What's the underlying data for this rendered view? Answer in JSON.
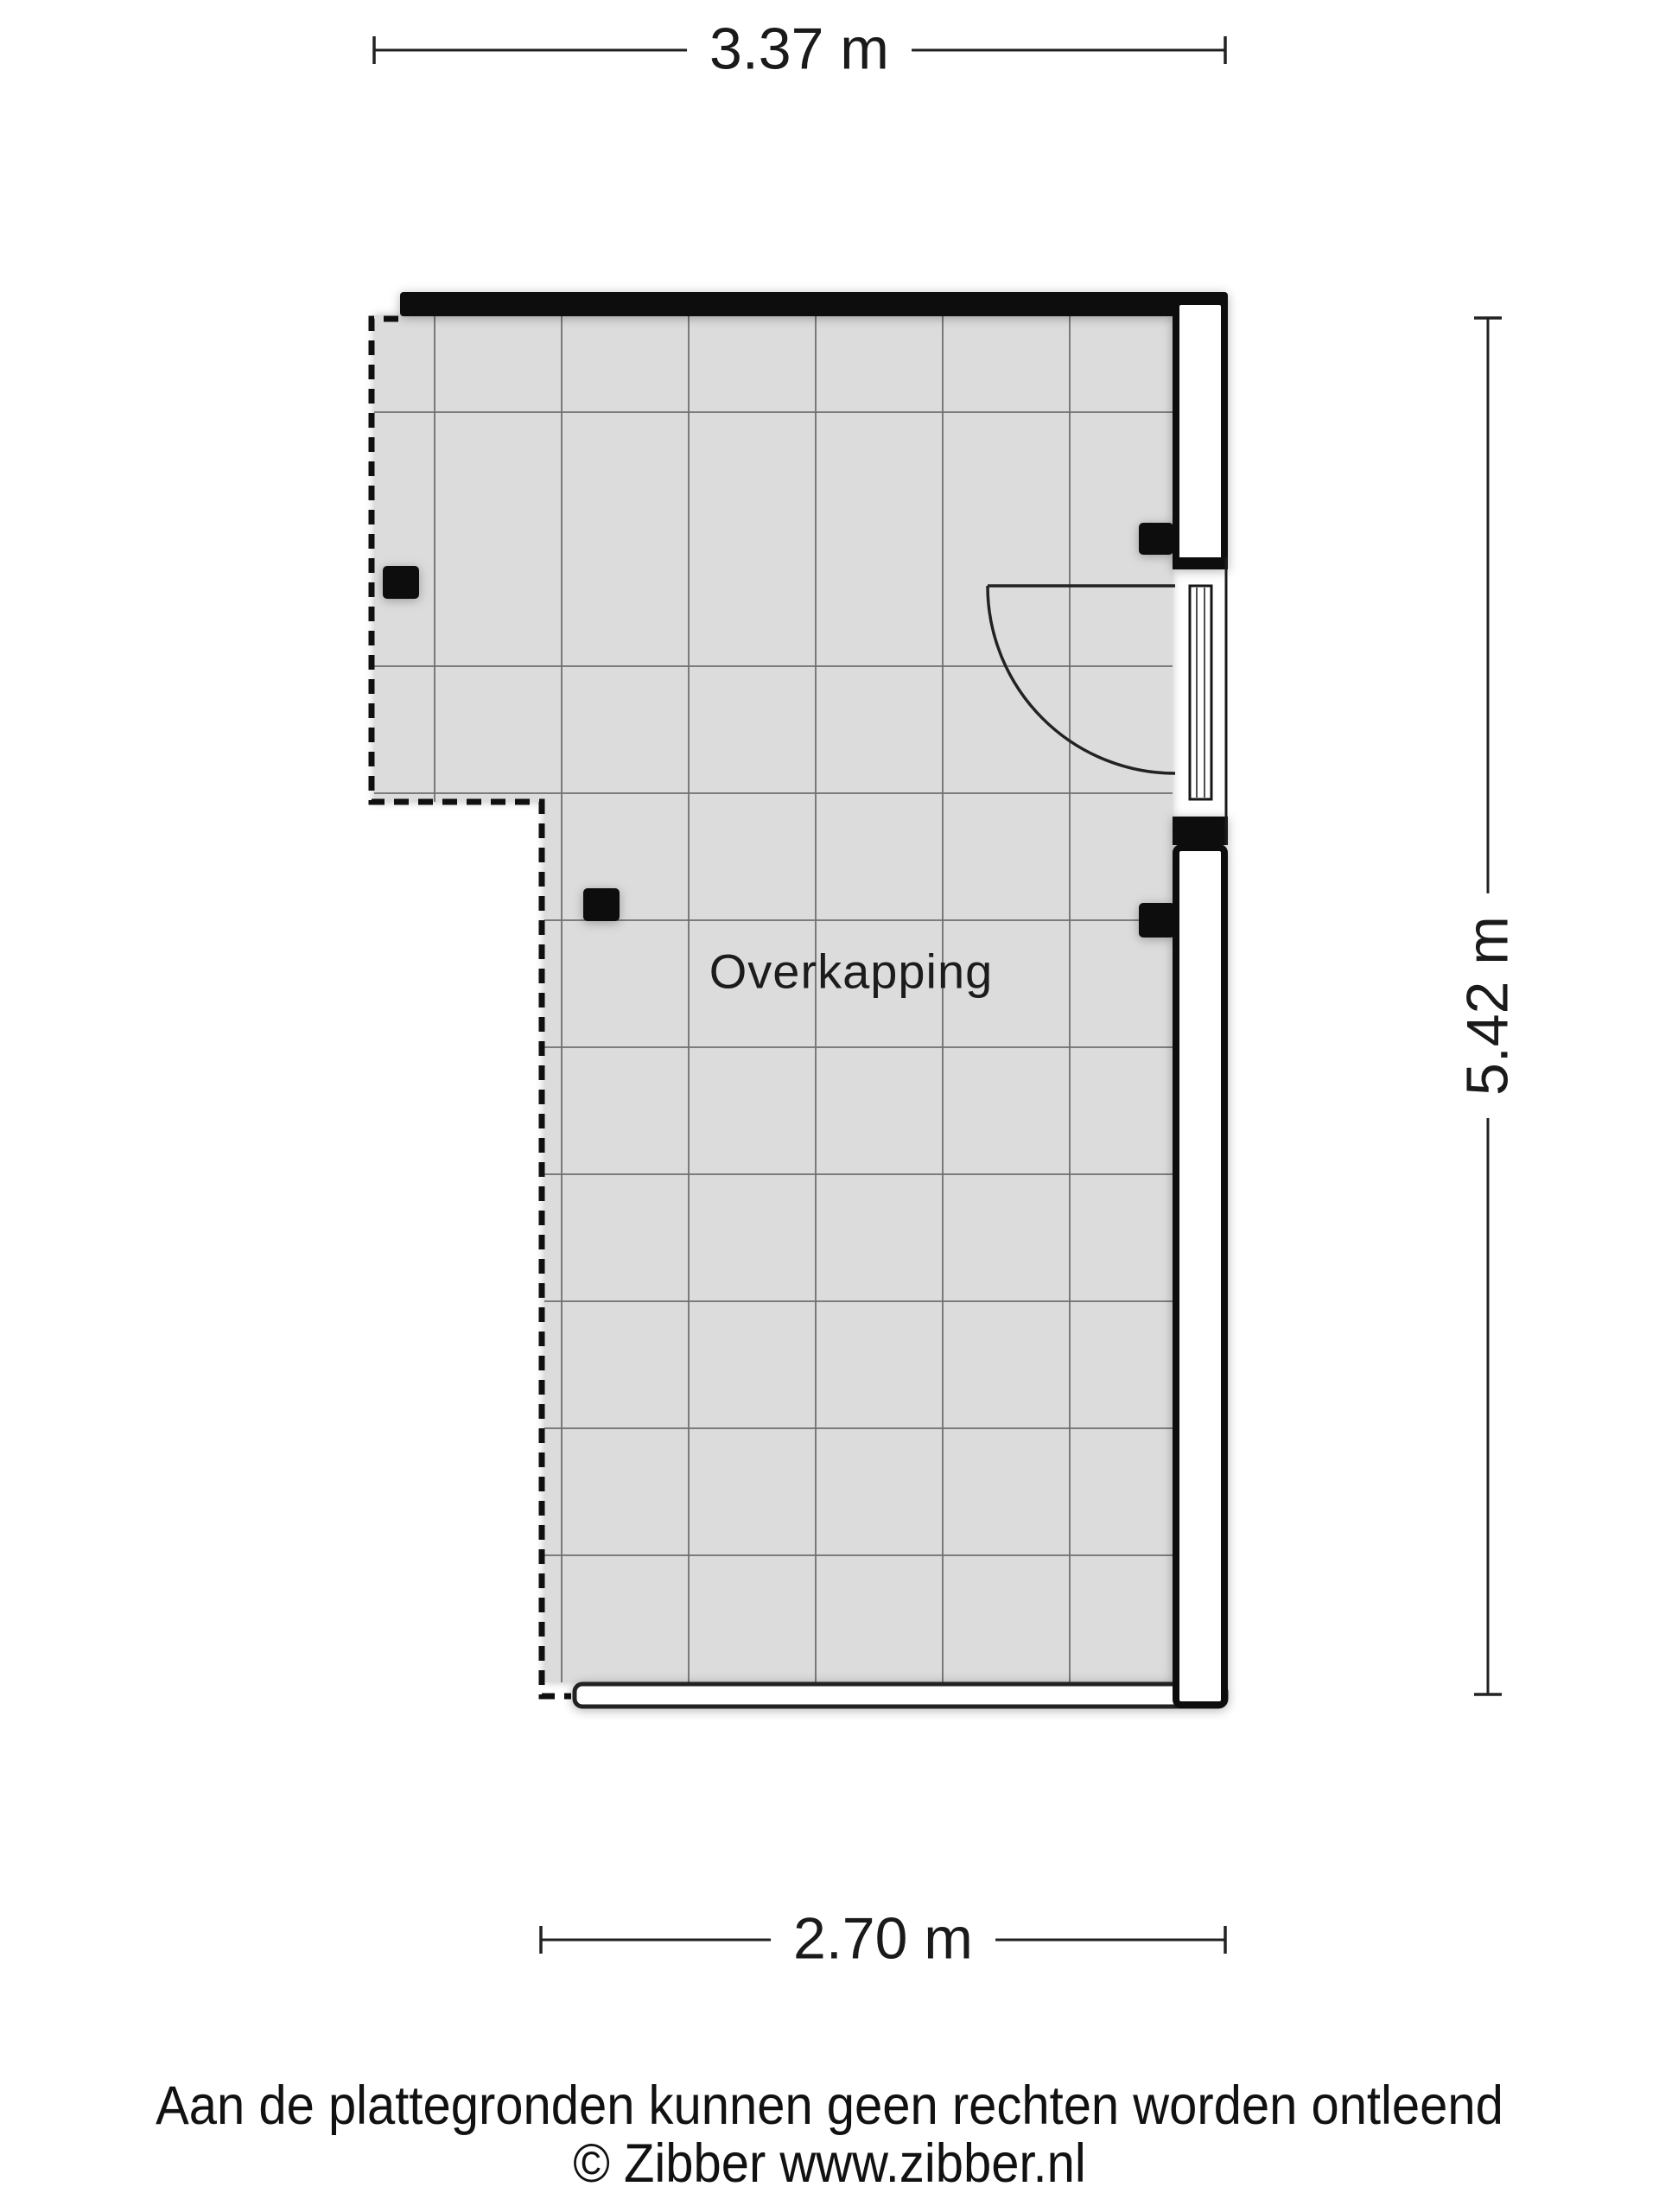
{
  "floor_plan": {
    "room_label": "Overkapping",
    "dimensions": {
      "width_top": "3.37 m",
      "height_right": "5.42 m",
      "width_bottom": "2.70 m"
    },
    "colors": {
      "floor_fill": "#dcdcdc",
      "grid_line": "#6f6f6f",
      "wall_black": "#0d0d0d",
      "wall_white": "#ffffff",
      "outline": "#1a1a1a"
    }
  },
  "footer": {
    "disclaimer": "Aan de plattegronden kunnen geen rechten worden ontleend",
    "copyright": "© Zibber www.zibber.nl"
  }
}
